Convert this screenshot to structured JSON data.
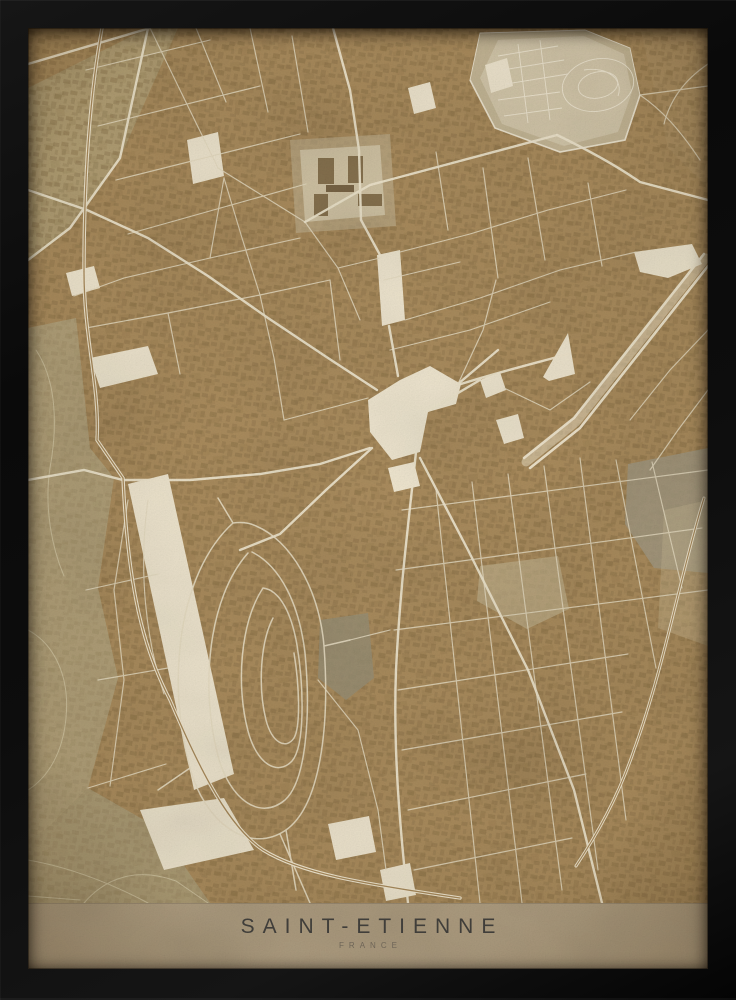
{
  "poster": {
    "title": "SAINT-ETIENNE",
    "subtitle": "FRANCE",
    "kind": "vintage sepia city map poster in a black frame",
    "map_city": "Saint-Etienne"
  },
  "colors": {
    "frame": "#0c0c0c",
    "map_base": "#ab8d5e",
    "street": "#e8dec4",
    "street_major": "#f1e8d0",
    "plaza_cream": "#f1e8d1",
    "cemetery": "#c7ba9b",
    "park_gray": "#9a9176",
    "title_band": "#b2a184",
    "title_text": "#403e3a",
    "subtitle_text": "#6e6557"
  }
}
